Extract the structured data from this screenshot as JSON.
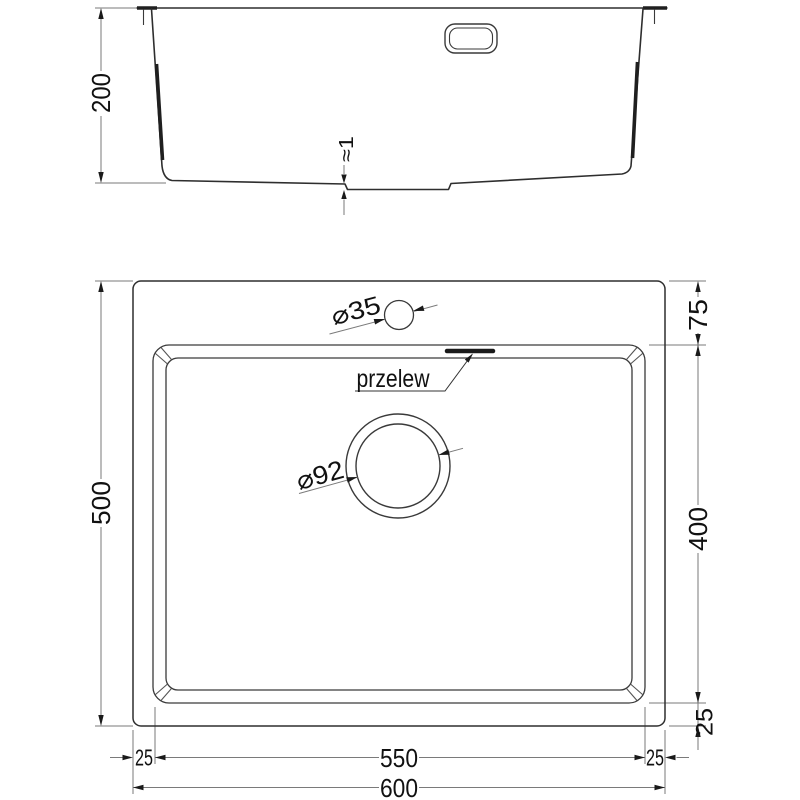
{
  "drawing": {
    "type": "sink-technical-dimension-drawing",
    "colors": {
      "object_line": "#2e2e2e",
      "thick_line": "#1f1f1f",
      "dimension_line": "#7a7a7a",
      "text": "#111111",
      "background": "#ffffff"
    },
    "section": {
      "depth": "200",
      "bottom_step": "≈1"
    },
    "plan": {
      "overall_width": "600",
      "overall_depth": "500",
      "bowl_width": "550",
      "bowl_depth": "400",
      "back_rim": "75",
      "front_rim": "25",
      "left_rim": "25",
      "right_rim": "25",
      "tap_hole_diameter": "⌀35",
      "drain_diameter": "⌀92",
      "overflow_label": "przelew"
    }
  }
}
